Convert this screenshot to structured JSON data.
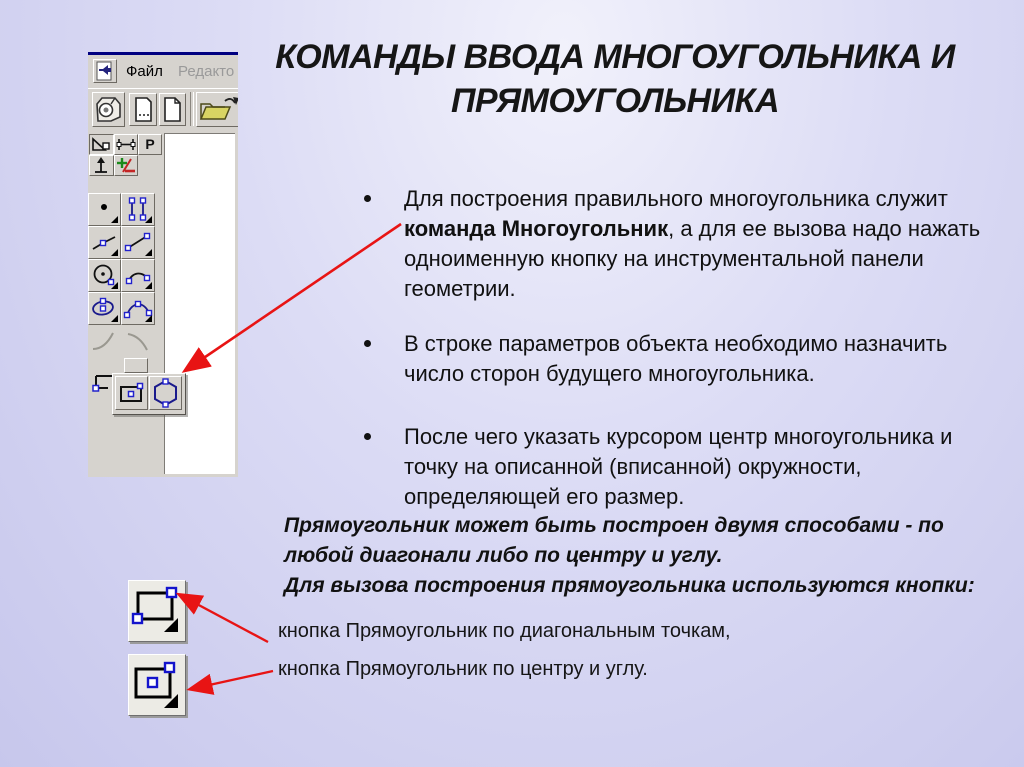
{
  "slide": {
    "title": "КОМАНДЫ ВВОДА МНОГОУГОЛЬНИКА И ПРЯМОУГОЛЬНИКА",
    "bullets": [
      {
        "pre": "Для построения правильного многоугольника служит ",
        "bold": "команда Многоугольник",
        "post": ", а для ее вызова надо нажать одноименную кнопку на инструментальной панели геометрии."
      },
      {
        "pre": "В строке параметров объекта необходимо назначить число сторон будущего многоугольника.",
        "bold": "",
        "post": ""
      },
      {
        "pre": "После чего указать курсором центр многоугольника и точку на описанной (вписанной) окружности, определяющей его размер.",
        "bold": "",
        "post": ""
      }
    ],
    "notes": [
      "Прямоугольник может быть построен двумя способами - по любой диагонали либо по центру и углу.",
      "Для вызова построения прямоугольника используются кнопки:"
    ],
    "captions": [
      "кнопка Прямоугольник по диагональным точкам,",
      "кнопка Прямоугольник по центру и углу."
    ]
  },
  "screenshot": {
    "menu": {
      "app_icon": "kompas-document-icon",
      "items": [
        "Файл",
        "Редакто"
      ]
    },
    "top_toolbar_icons": [
      "kompas-cube-icon",
      "new-document-icon",
      "new-sheet-icon",
      "open-folder-icon"
    ],
    "control_panel_icons": [
      "triangle-ruler-icon",
      "measure-icon",
      "p-letter-icon",
      "vertical-arrow-icon",
      "plus-minus-icon"
    ],
    "geometry_icons": [
      "point-icon",
      "parallel-segments-icon",
      "polyline-icon",
      "segment-icon",
      "circle-icon",
      "arc-icon",
      "ellipse-icon",
      "curve-icon",
      "fillet-icon",
      "chamfer-icon"
    ],
    "flyout_icons": [
      "rectangle-by-center-icon",
      "polygon-icon"
    ]
  },
  "big_buttons": {
    "diagonal_icon": "rectangle-by-diagonal-points-icon",
    "center_icon": "rectangle-by-center-and-angle-icon"
  },
  "colors": {
    "accent_red": "#e81414",
    "navy": "#000080",
    "toolbar_gray": "#d6d3ce",
    "point_blue": "#2222cc",
    "text": "#111111"
  }
}
